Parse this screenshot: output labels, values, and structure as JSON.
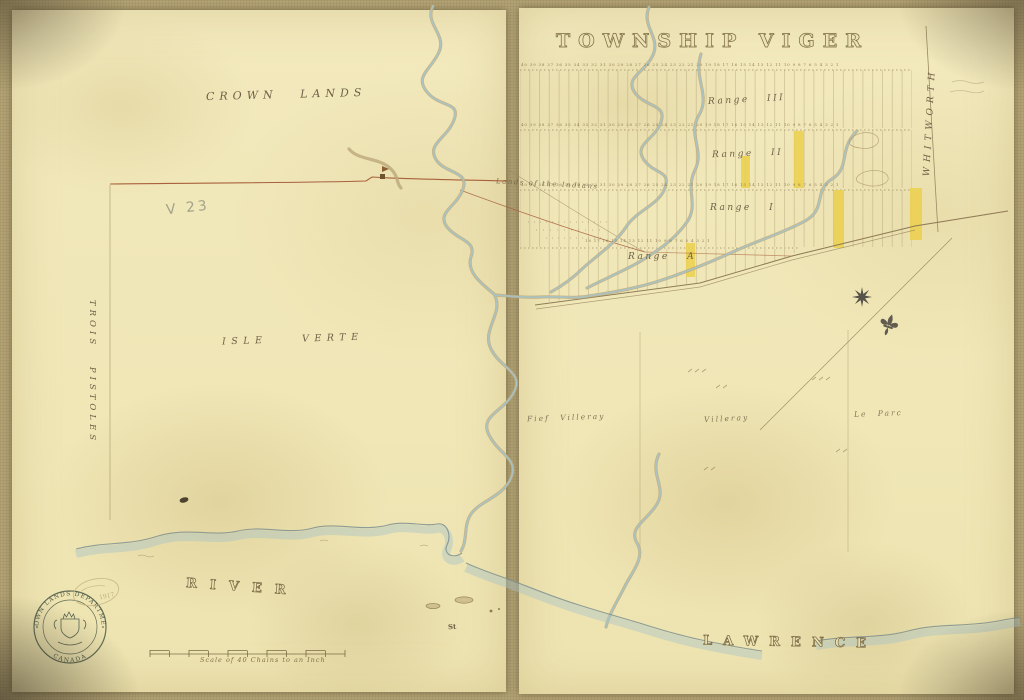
{
  "title": {
    "text": "TOWNSHIP VIGER"
  },
  "labels": {
    "crown_lands": "CROWN LANDS",
    "isle_verte": "ISLE VERTE",
    "trois_pistoles": "TROIS PISTOLES",
    "whitworth": "WHITWORTH",
    "lands_of_indians": "Lands of the Indians",
    "fief_villeray": "Fief Villeray",
    "villeray": "Villeray",
    "le_parc": "Le Parc",
    "river": "RIVER",
    "st_abbrev": "St",
    "lawrence": "LAWRENCE",
    "pencil_note": "V 23"
  },
  "ranges": {
    "r3": "Range III",
    "r2": "Range II",
    "r1": "Range I",
    "ra": "Range A"
  },
  "lot_numbers": {
    "row_top": "40 39 38 37 36 35 34 33 32 31 30 29 28 27 26 25 24 23 22 21 20 19 18 17 16 15 14 13 12 11 10 9 8 7 6 5 4 3 2 1",
    "row_mid": "40 39 38 37 36 35 34 33 32 31 30 29 28 27 26 25 24 23 22 21 20 19 18 17 16 15 14 13 12 11 10 9 8 7 6 5 4 3 2 1",
    "row_low": "40 39 38 37 36 35 34 33 32 31 30 29 28 27 26 25 24 23 22 21 20 19 18 17 16 15 14 13 12 11 10 9 8 7 6 5 4 3 2 1",
    "row_a": "18 17 16 15 14 13 12 11 10 9 8 7 6 5 4 3 2 1"
  },
  "scale_bar": {
    "label": "Scale of 40 Chains to an Inch"
  },
  "stamp": {
    "arc_top": "CROWN LANDS DEPARTMENT",
    "arc_bottom": "CANADA",
    "year": "1917"
  },
  "colors": {
    "paper": "#f1e8ba",
    "cloth": "#b2a274",
    "ink": "#7d6c46",
    "boundary_red": "#a8613c",
    "water": "#a9c4c6",
    "lot_highlight": "#ecd04b",
    "stamp_green": "#41503f",
    "pencil_gray": "#8f927e"
  }
}
